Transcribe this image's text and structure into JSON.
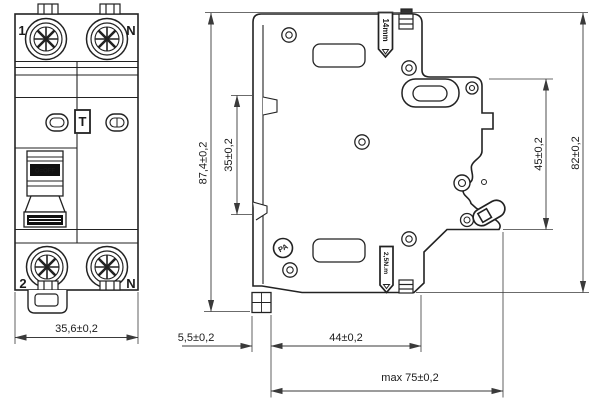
{
  "colors": {
    "line": "#222222",
    "dimension": "#3a3a3a",
    "background": "#ffffff",
    "label_fill": "#111111"
  },
  "front_view": {
    "terminals": {
      "top_left": "1",
      "top_right": "N",
      "bottom_left": "2",
      "bottom_right": "N"
    },
    "test_button": "T",
    "switch_label": "O=OFF"
  },
  "side_view": {
    "strip_length_tag": "14mm",
    "torque_tag": "2,5N.m",
    "material_tag": "PA"
  },
  "dimensions": {
    "front_width": "35,6±0,2",
    "total_height": "87,4±0,2",
    "rail_recess_height": "35±0,2",
    "upper_depth": "45±0,2",
    "overall_depth": "82±0,2",
    "front_offset": "5,5±0,2",
    "mounting_depth": "44±0,2",
    "max_depth": "max 75±0,2"
  }
}
